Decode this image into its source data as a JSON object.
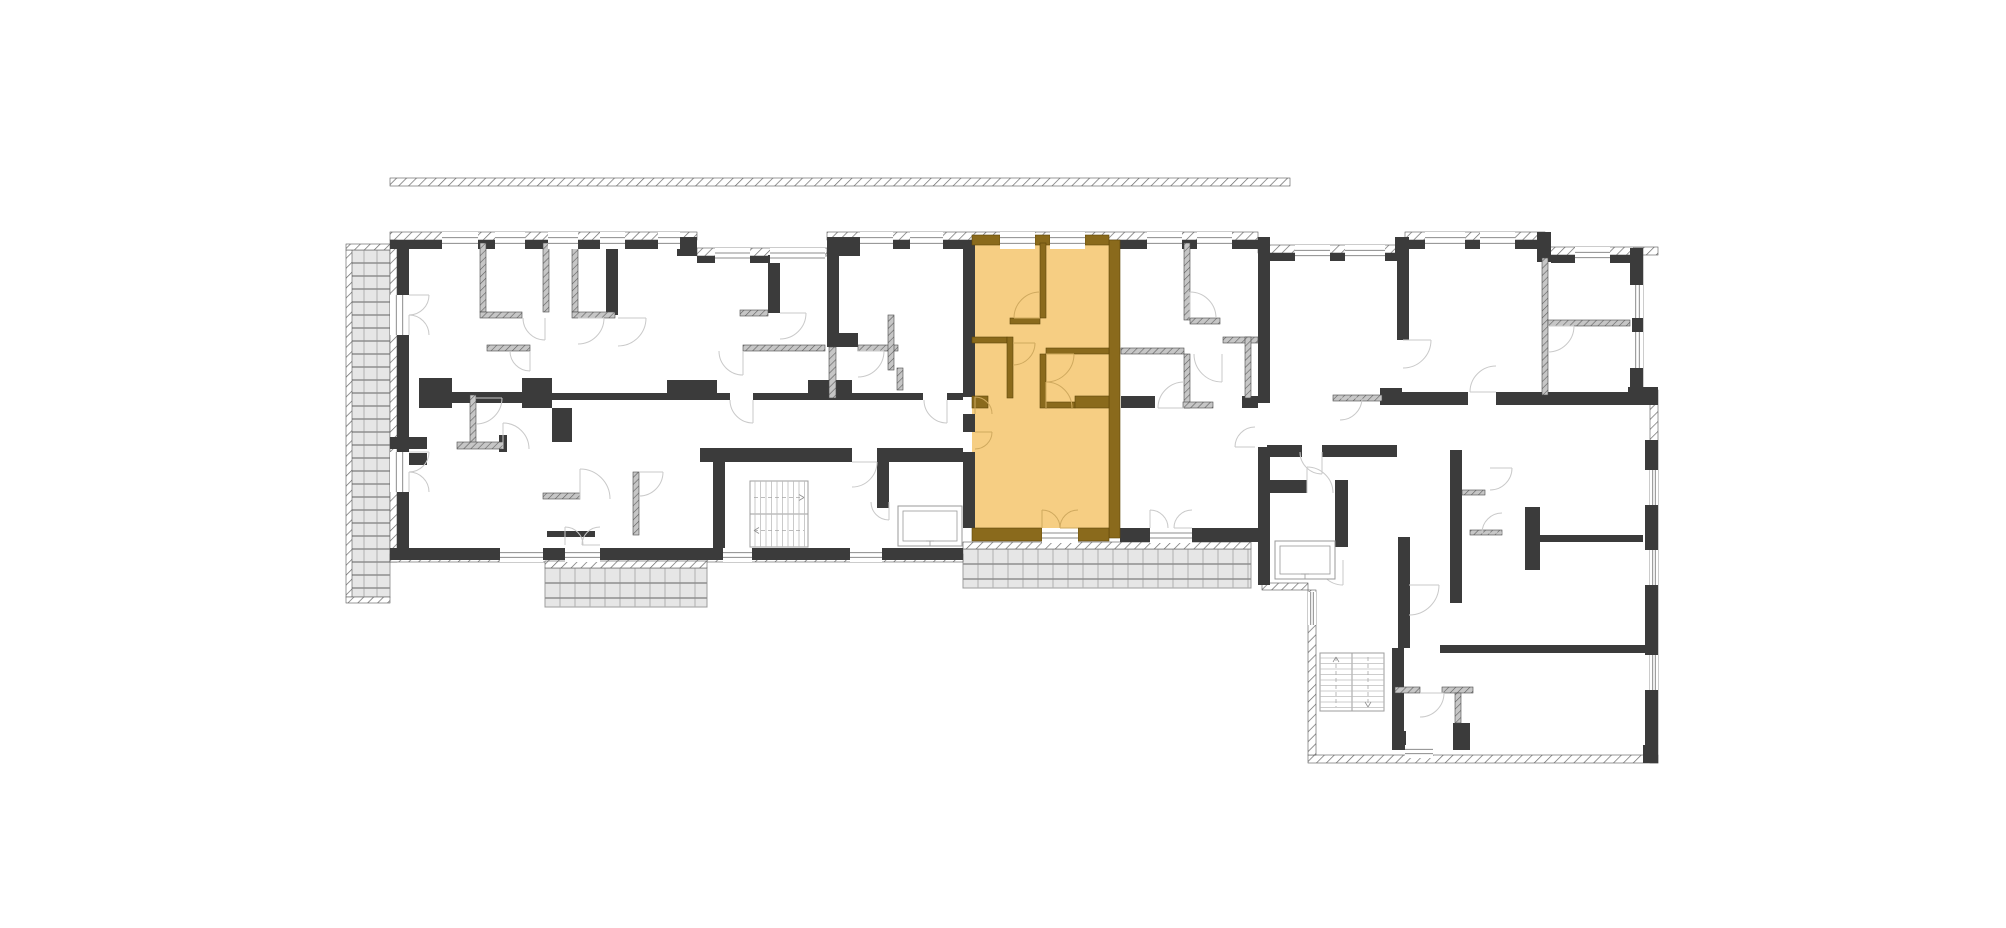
{
  "plan": {
    "w": 2006,
    "h": 928,
    "colors": {
      "bg": "#ffffff",
      "wall_black": "#3b3b3b",
      "wall_thin_base": "#c6c6c6",
      "wall_thin_line": "#5f5f5f",
      "wall_brown": "#8a6a1c",
      "wall_brown_edge": "#5f4708",
      "unit_fill": "#f6ce83",
      "arc_gray": "#c9c9c9",
      "arc_orange": "#cfa95e",
      "hatch_line": "#6a6a6a",
      "hatch_edge": "#555555",
      "window_line": "#8c8c8c",
      "balcony_fill": "#e6e6e6",
      "balcony_line_v": "#b0b0b0",
      "balcony_line_h": "#8e8e8e",
      "stair_step": "#bdbdbd",
      "stair_border": "#9d9d9d",
      "stair_dash": "#a8a8a8",
      "lift_line": "#9a9a9a"
    },
    "unit": {
      "rect": [
        972,
        238,
        137,
        300
      ]
    },
    "hatch": [
      [
        390,
        178,
        900,
        8
      ],
      [
        390,
        232,
        307,
        8
      ],
      [
        697,
        248,
        130,
        8
      ],
      [
        827,
        232,
        431,
        8
      ],
      [
        1258,
        245,
        147,
        8
      ],
      [
        1405,
        232,
        140,
        8
      ],
      [
        1545,
        247,
        113,
        8
      ],
      [
        390,
        240,
        7,
        322
      ],
      [
        390,
        554,
        573,
        8
      ],
      [
        1635,
        248,
        8,
        139
      ],
      [
        1650,
        390,
        8,
        373
      ],
      [
        1308,
        755,
        350,
        8
      ],
      [
        1308,
        590,
        8,
        165
      ],
      [
        1262,
        583,
        46,
        7
      ],
      [
        963,
        542,
        288,
        7
      ],
      [
        545,
        561,
        162,
        7
      ],
      [
        346,
        250,
        6,
        347
      ],
      [
        346,
        244,
        44,
        6
      ],
      [
        346,
        597,
        44,
        6
      ]
    ],
    "black": [
      [
        390,
        240,
        52,
        9
      ],
      [
        478,
        240,
        17,
        9
      ],
      [
        525,
        240,
        23,
        9
      ],
      [
        578,
        240,
        22,
        9
      ],
      [
        625,
        240,
        33,
        9
      ],
      [
        680,
        240,
        17,
        9
      ],
      [
        677,
        237,
        20,
        19
      ],
      [
        827,
        237,
        33,
        19
      ],
      [
        697,
        256,
        18,
        7
      ],
      [
        750,
        256,
        20,
        7
      ],
      [
        827,
        240,
        33,
        9
      ],
      [
        893,
        240,
        17,
        9
      ],
      [
        943,
        240,
        32,
        9
      ],
      [
        1115,
        240,
        32,
        9
      ],
      [
        1182,
        240,
        15,
        9
      ],
      [
        1232,
        240,
        26,
        9
      ],
      [
        1258,
        240,
        12,
        9
      ],
      [
        1258,
        237,
        12,
        22
      ],
      [
        1270,
        253,
        25,
        8
      ],
      [
        1330,
        253,
        15,
        8
      ],
      [
        1385,
        253,
        20,
        8
      ],
      [
        1395,
        237,
        14,
        24
      ],
      [
        1405,
        240,
        20,
        9
      ],
      [
        1465,
        240,
        15,
        9
      ],
      [
        1515,
        240,
        30,
        9
      ],
      [
        1537,
        232,
        14,
        30
      ],
      [
        1551,
        255,
        24,
        8
      ],
      [
        1610,
        255,
        33,
        8
      ],
      [
        397,
        240,
        12,
        55
      ],
      [
        397,
        335,
        12,
        117
      ],
      [
        397,
        492,
        12,
        62
      ],
      [
        390,
        548,
        110,
        12
      ],
      [
        543,
        548,
        22,
        12
      ],
      [
        600,
        548,
        123,
        12
      ],
      [
        752,
        548,
        98,
        12
      ],
      [
        882,
        548,
        81,
        12
      ],
      [
        1120,
        528,
        30,
        14
      ],
      [
        1192,
        528,
        66,
        14
      ],
      [
        963,
        240,
        12,
        157
      ],
      [
        963,
        414,
        12,
        18
      ],
      [
        963,
        452,
        12,
        76
      ],
      [
        1258,
        249,
        12,
        154
      ],
      [
        1258,
        447,
        12,
        93
      ],
      [
        1258,
        540,
        12,
        45
      ],
      [
        606,
        243,
        12,
        72
      ],
      [
        428,
        392,
        97,
        11
      ],
      [
        419,
        378,
        33,
        30
      ],
      [
        522,
        378,
        30,
        30
      ],
      [
        552,
        393,
        178,
        7
      ],
      [
        753,
        393,
        99,
        7
      ],
      [
        852,
        393,
        71,
        7
      ],
      [
        947,
        393,
        16,
        7
      ],
      [
        667,
        380,
        50,
        18
      ],
      [
        808,
        380,
        44,
        18
      ],
      [
        390,
        437,
        37,
        12
      ],
      [
        552,
        408,
        20,
        34
      ],
      [
        499,
        435,
        8,
        17
      ],
      [
        547,
        531,
        48,
        6
      ],
      [
        395,
        453,
        32,
        12
      ],
      [
        768,
        255,
        12,
        58
      ],
      [
        827,
        237,
        12,
        110
      ],
      [
        832,
        333,
        26,
        14
      ],
      [
        700,
        448,
        152,
        14
      ],
      [
        877,
        448,
        86,
        14
      ],
      [
        713,
        462,
        12,
        86
      ],
      [
        877,
        462,
        12,
        46
      ],
      [
        1121,
        396,
        34,
        12
      ],
      [
        1242,
        396,
        16,
        12
      ],
      [
        1397,
        258,
        12,
        82
      ],
      [
        1402,
        392,
        66,
        13
      ],
      [
        1496,
        392,
        161,
        13
      ],
      [
        1380,
        388,
        22,
        17
      ],
      [
        1267,
        445,
        35,
        12
      ],
      [
        1322,
        445,
        75,
        12
      ],
      [
        1267,
        480,
        40,
        13
      ],
      [
        1335,
        480,
        13,
        67
      ],
      [
        1628,
        387,
        30,
        18
      ],
      [
        1630,
        248,
        13,
        37
      ],
      [
        1632,
        318,
        11,
        14
      ],
      [
        1630,
        368,
        13,
        22
      ],
      [
        1645,
        440,
        13,
        30
      ],
      [
        1645,
        505,
        13,
        45
      ],
      [
        1645,
        585,
        13,
        70
      ],
      [
        1645,
        690,
        13,
        55
      ],
      [
        1643,
        745,
        15,
        18
      ],
      [
        1538,
        535,
        105,
        7
      ],
      [
        1525,
        507,
        15,
        63
      ],
      [
        1450,
        450,
        12,
        153
      ],
      [
        1440,
        645,
        205,
        8
      ],
      [
        1398,
        537,
        12,
        111
      ],
      [
        1392,
        648,
        12,
        102
      ],
      [
        1392,
        731,
        14,
        19
      ],
      [
        1453,
        723,
        17,
        27
      ]
    ],
    "thin": [
      [
        480,
        243,
        6,
        69
      ],
      [
        543,
        243,
        6,
        69
      ],
      [
        572,
        243,
        6,
        69
      ],
      [
        480,
        312,
        42,
        6
      ],
      [
        572,
        312,
        43,
        6
      ],
      [
        487,
        345,
        43,
        6
      ],
      [
        470,
        395,
        6,
        53
      ],
      [
        457,
        442,
        46,
        7
      ],
      [
        633,
        472,
        6,
        63
      ],
      [
        543,
        493,
        37,
        6
      ],
      [
        740,
        310,
        28,
        6
      ],
      [
        743,
        345,
        82,
        6
      ],
      [
        858,
        345,
        40,
        6
      ],
      [
        888,
        315,
        6,
        55
      ],
      [
        897,
        368,
        6,
        22
      ],
      [
        829,
        347,
        7,
        51
      ],
      [
        1184,
        243,
        6,
        77
      ],
      [
        1190,
        318,
        30,
        6
      ],
      [
        1121,
        348,
        63,
        6
      ],
      [
        1223,
        337,
        35,
        6
      ],
      [
        1245,
        337,
        6,
        61
      ],
      [
        1184,
        354,
        6,
        54
      ],
      [
        1183,
        402,
        30,
        6
      ],
      [
        1333,
        395,
        49,
        6
      ],
      [
        1542,
        258,
        6,
        137
      ],
      [
        1548,
        320,
        82,
        6
      ],
      [
        1462,
        490,
        23,
        5
      ],
      [
        1470,
        530,
        32,
        5
      ],
      [
        1395,
        687,
        25,
        6
      ],
      [
        1442,
        687,
        31,
        6
      ],
      [
        1455,
        693,
        6,
        30
      ]
    ],
    "brown": [
      [
        1109,
        240,
        11,
        298
      ],
      [
        972,
        235,
        28,
        10
      ],
      [
        1035,
        235,
        15,
        10
      ],
      [
        1085,
        235,
        24,
        10
      ],
      [
        1040,
        243,
        6,
        75
      ],
      [
        1010,
        318,
        30,
        6
      ],
      [
        972,
        337,
        35,
        6
      ],
      [
        1007,
        337,
        6,
        61
      ],
      [
        1046,
        348,
        63,
        6
      ],
      [
        1040,
        354,
        6,
        54
      ],
      [
        1046,
        402,
        29,
        6
      ],
      [
        1075,
        396,
        34,
        12
      ],
      [
        972,
        396,
        16,
        12
      ],
      [
        972,
        528,
        70,
        13
      ],
      [
        1078,
        528,
        31,
        13
      ]
    ],
    "win_h": [
      [
        442,
        232,
        36,
        17
      ],
      [
        495,
        232,
        30,
        17
      ],
      [
        548,
        232,
        30,
        17
      ],
      [
        600,
        232,
        25,
        17
      ],
      [
        658,
        232,
        22,
        17
      ],
      [
        715,
        248,
        35,
        15
      ],
      [
        770,
        248,
        55,
        15
      ],
      [
        860,
        232,
        33,
        17
      ],
      [
        910,
        232,
        33,
        17
      ],
      [
        1147,
        232,
        35,
        17
      ],
      [
        1197,
        232,
        35,
        17
      ],
      [
        1000,
        232,
        35,
        17
      ],
      [
        1050,
        232,
        35,
        17
      ],
      [
        1295,
        245,
        35,
        16
      ],
      [
        1345,
        245,
        40,
        16
      ],
      [
        1425,
        232,
        40,
        17
      ],
      [
        1480,
        232,
        35,
        17
      ],
      [
        1575,
        247,
        35,
        16
      ],
      [
        500,
        548,
        43,
        14
      ],
      [
        565,
        548,
        35,
        14
      ],
      [
        723,
        548,
        29,
        14
      ],
      [
        850,
        548,
        32,
        14
      ],
      [
        1042,
        528,
        36,
        15
      ],
      [
        1150,
        528,
        42,
        15
      ],
      [
        1405,
        745,
        28,
        13
      ]
    ],
    "win_v": [
      [
        390,
        295,
        19,
        40
      ],
      [
        390,
        452,
        19,
        40
      ],
      [
        1632,
        285,
        11,
        33
      ],
      [
        1632,
        332,
        11,
        36
      ],
      [
        1650,
        470,
        8,
        35
      ],
      [
        1650,
        550,
        8,
        35
      ],
      [
        1650,
        655,
        8,
        35
      ],
      [
        1308,
        592,
        8,
        33
      ]
    ],
    "arcs": [
      [
        409,
        295,
        20,
        0,
        90,
        0
      ],
      [
        409,
        335,
        20,
        270,
        360,
        0
      ],
      [
        409,
        452,
        20,
        0,
        90,
        0
      ],
      [
        409,
        492,
        20,
        270,
        360,
        0
      ],
      [
        545,
        318,
        22,
        90,
        180,
        0
      ],
      [
        578,
        318,
        26,
        0,
        90,
        0
      ],
      [
        618,
        318,
        28,
        0,
        90,
        0
      ],
      [
        530,
        351,
        20,
        90,
        180,
        0
      ],
      [
        476,
        398,
        26,
        0,
        90,
        0
      ],
      [
        503,
        449,
        26,
        270,
        360,
        0
      ],
      [
        580,
        499,
        30,
        270,
        360,
        0
      ],
      [
        639,
        472,
        24,
        0,
        90,
        0
      ],
      [
        565,
        545,
        18,
        270,
        360,
        0
      ],
      [
        600,
        545,
        18,
        180,
        270,
        0
      ],
      [
        780,
        313,
        26,
        0,
        90,
        0
      ],
      [
        743,
        351,
        24,
        90,
        180,
        0
      ],
      [
        858,
        351,
        26,
        0,
        90,
        0
      ],
      [
        753,
        400,
        23,
        90,
        180,
        0
      ],
      [
        947,
        400,
        23,
        90,
        180,
        0
      ],
      [
        852,
        462,
        25,
        0,
        90,
        0
      ],
      [
        889,
        502,
        18,
        90,
        180,
        0
      ],
      [
        1040,
        318,
        26,
        180,
        270,
        1
      ],
      [
        1013,
        343,
        22,
        0,
        90,
        1
      ],
      [
        1046,
        354,
        28,
        0,
        90,
        1
      ],
      [
        1046,
        408,
        26,
        270,
        360,
        1
      ],
      [
        975,
        414,
        17,
        270,
        360,
        1
      ],
      [
        975,
        432,
        17,
        0,
        90,
        1
      ],
      [
        1042,
        528,
        18,
        270,
        360,
        1
      ],
      [
        1078,
        528,
        18,
        180,
        270,
        1
      ],
      [
        1190,
        318,
        26,
        270,
        360,
        0
      ],
      [
        1222,
        354,
        28,
        90,
        180,
        0
      ],
      [
        1184,
        408,
        26,
        180,
        270,
        0
      ],
      [
        1255,
        447,
        20,
        180,
        270,
        0
      ],
      [
        1150,
        528,
        18,
        270,
        360,
        0
      ],
      [
        1192,
        528,
        18,
        180,
        270,
        0
      ],
      [
        1322,
        452,
        22,
        90,
        180,
        0
      ],
      [
        1340,
        398,
        22,
        0,
        90,
        0
      ],
      [
        1307,
        493,
        26,
        270,
        360,
        0
      ],
      [
        1403,
        340,
        28,
        0,
        90,
        0
      ],
      [
        1548,
        326,
        26,
        0,
        90,
        0
      ],
      [
        1496,
        392,
        26,
        180,
        270,
        0
      ],
      [
        1409,
        585,
        30,
        0,
        90,
        0
      ],
      [
        1490,
        468,
        22,
        0,
        90,
        0
      ],
      [
        1502,
        533,
        20,
        180,
        270,
        0
      ],
      [
        1420,
        693,
        24,
        0,
        90,
        0
      ],
      [
        1343,
        560,
        25,
        90,
        180,
        0
      ]
    ],
    "balconies": [
      [
        351,
        250,
        39,
        347,
        13
      ],
      [
        545,
        568,
        162,
        39,
        15
      ],
      [
        963,
        549,
        288,
        39,
        15
      ]
    ],
    "stairs": [
      {
        "x": 750,
        "y": 481,
        "w": 58,
        "h": 66,
        "dir": "h"
      },
      {
        "x": 1320,
        "y": 653,
        "w": 64,
        "h": 58,
        "dir": "v"
      }
    ],
    "lifts": [
      [
        898,
        506,
        64,
        40
      ],
      [
        1275,
        541,
        60,
        38
      ]
    ]
  }
}
